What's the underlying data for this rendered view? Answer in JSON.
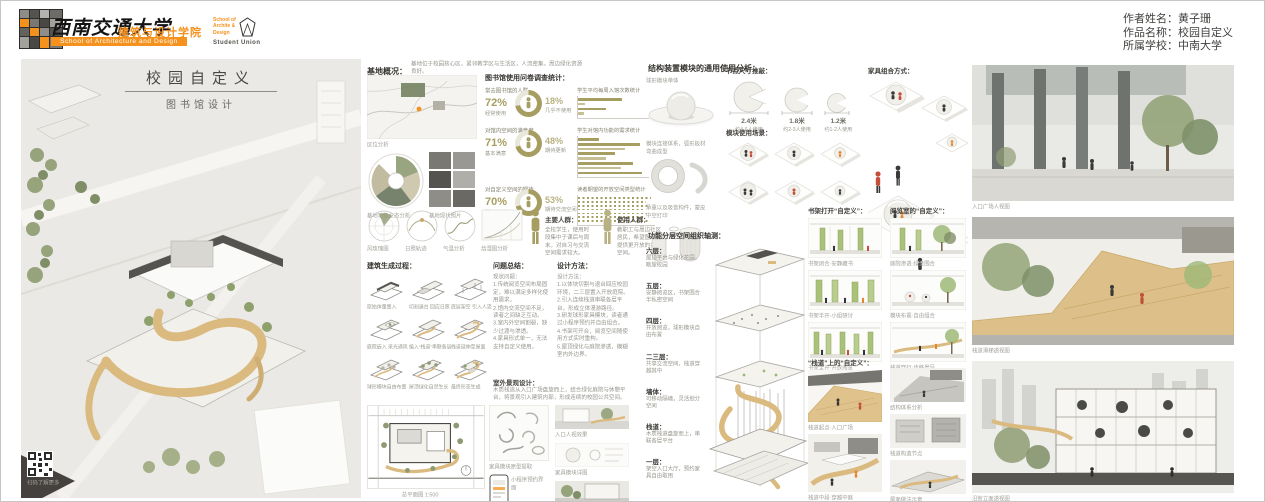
{
  "colors": {
    "accent_orange": "#f5921e",
    "olive": "#a69e61",
    "wood": "#d9b87e",
    "green": "#9db878"
  },
  "header": {
    "university_cn": "西南交通大学",
    "school_cn": "建筑与设计学院",
    "school_en": "School of Architecture and Design",
    "badge_line1": "School of",
    "badge_line2": "Archite &",
    "badge_line3": "Design",
    "badge_union": "Student Union",
    "author_rows": [
      {
        "label": "作者姓名：",
        "value": "黄子珊"
      },
      {
        "label": "作品名称：",
        "value": "校园自定义"
      },
      {
        "label": "所属学校：",
        "value": "中南大学"
      }
    ]
  },
  "left": {
    "title": "校园自定义",
    "subtitle": "图书馆设计",
    "qr_caption": "扫码了解更多",
    "site_heading": "基地概况：",
    "site_note": "基地位于校园核心区，紧邻教学区与生活区，人流密集，周边绿化资源良好。",
    "map_caption": "区位分析",
    "fan_caption": "基地功能业态分析",
    "photos_caption": "基地现状照片",
    "survey_heading": "图书馆使用问卷调查统计：",
    "surveys": [
      {
        "title": "常去图书馆的人群",
        "pct": "72%",
        "val": 72,
        "pct_note": "经常使用",
        "side_pct": "18%",
        "side_note": "几乎不使用",
        "bars_title": "学生平均每周入馆次数统计",
        "bars": [
          62,
          10,
          40,
          8
        ]
      },
      {
        "title": "对馆内空间的满意度",
        "pct": "71%",
        "val": 71,
        "pct_note": "基本满意",
        "side_pct": "48%",
        "side_note": "期待更新",
        "bars_title": "学生对馆内功能的需求统计",
        "bars": [
          30,
          88,
          66,
          52,
          40,
          78,
          60,
          90
        ]
      },
      {
        "title": "对自定义空间的期待",
        "pct": "70%",
        "val": 70,
        "pct_note": "愿意尝试",
        "side_pct": "53%",
        "side_note": "期待交流空间",
        "bars_title": "读者期望的开放空间类型统计",
        "bars": [
          95,
          88,
          92,
          85,
          90,
          86,
          93
        ]
      }
    ],
    "climate_captions": [
      "风玫瑰图",
      "日照轨迹",
      "气温分析",
      "焓湿图分析"
    ],
    "crowd1_head": "主要人群：",
    "crowd1_text": "全校学生，使用时段集中于课后与周末，对自习与交流空间需求较大。",
    "crowd2_head": "使用人群：",
    "crowd2_text": "教职工与周边社区居民，希望图书馆提供更开放的共享空间。",
    "gen_heading": "建筑生成过程：",
    "gen_steps": [
      "原始体量置入",
      "切割退台 回应日照",
      "底层架空 引入人流",
      "庭院嵌入 采光通风",
      "植入“栈道”串联各层",
      "栈道延伸至屋面",
      "球形模块自由布置",
      "屋顶绿化自然生长",
      "最终形态生成"
    ],
    "problem_heading": "问题总结：",
    "problem_text": "现状问题：\n1.传统阅览空间布局固定，难以满足多样化使用需求。\n2.馆内交流空间不足，读者之间缺乏互动。\n3.室内外空间割裂，缺少过渡与渗透。\n4.家具形式单一，无法支持自定义使用。",
    "method_heading": "设计方法：",
    "method_text": "设计方法：\n1.以体块切割与退台回应校园环境，二三层置入开放庭院。\n2.引入连续栈道串联各层平台，形成立体漫游路径。\n3.研发球形家具模块，读者通过小程序预约并自由组合。\n4.书架可开合，阅览空间随使用方式实时重构。\n5.屋顶绿化与庭院渗透，模糊室内外边界。",
    "landscape_heading": "室外景观设计：",
    "landscape_text": "木质栈道从入口广场盘旋而上，结合绿化庭院与休憩平台，将景观引入建筑内部，形成连续的校园公共空间。",
    "siteplan_label": "总平面图 1:500",
    "shapes_label": "家具模块原型提取",
    "phone_label": "小程序预约界面",
    "thumb_captions": [
      "入口人视效果",
      "家具模块详图",
      "沿街人视效果"
    ]
  },
  "right": {
    "module_heading": "结构装置模块的通用使用分析：",
    "module_labels": [
      "球形模块单体",
      "模块连接体系，弧形板材弯曲成型",
      "承重以及吸音构件，蒙皮中空打印"
    ],
    "dim_heading": "节点尺寸推敲：",
    "dims": [
      {
        "size": "2.4米",
        "note": "约4-6人使用"
      },
      {
        "size": "1.8米",
        "note": "约2-3人使用"
      },
      {
        "size": "1.2米",
        "note": "约1-2人使用"
      }
    ],
    "scene_heading": "模块使用场景：",
    "furniture_heading": "家具组合方式：",
    "axo_heading": "功能分层空间组织轴测：",
    "floors": [
      {
        "name": "六层：",
        "note": "屋顶平台与绿化花园，眺望校园"
      },
      {
        "name": "五层：",
        "note": "安静阅览区，书架围合半私密空间"
      },
      {
        "name": "四层：",
        "note": "开放阅览，球形模块自由布置"
      },
      {
        "name": "二三层：",
        "note": "共享交流空间，栈道穿越其中"
      },
      {
        "name": "墙体：",
        "note": "可移动隔墙，灵活划分空间"
      },
      {
        "name": "栈道：",
        "note": "木质栈道盘旋而上，串联各层平台"
      },
      {
        "name": "一层：",
        "note": "架空入口大厅，预约家具自由取用"
      }
    ],
    "section_heading_1": "书架打开“自定义”：",
    "section_heading_2": "阅览室的“自定义”：",
    "section_captions_1": [
      "书架闭合·安静藏书",
      "书架半开·小组研讨",
      "书架全开·开放阅览"
    ],
    "section_captions_2": [
      "庭院渗透·绿意围合",
      "模块布置·自由组合",
      "栈道穿行·步移景异"
    ],
    "ramp_heading": "“栈道”上的“自定义”：",
    "ramp_captions_1": [
      "栈道起点·入口广场",
      "栈道中段·穿越中庭"
    ],
    "ramp_captions_2": [
      "结构体系分析",
      "栈道构造节点",
      "屋面做法示意"
    ],
    "render_captions": [
      "入口广场人视图",
      "栈道滑梯透视图",
      "沿街立面透视图"
    ]
  }
}
